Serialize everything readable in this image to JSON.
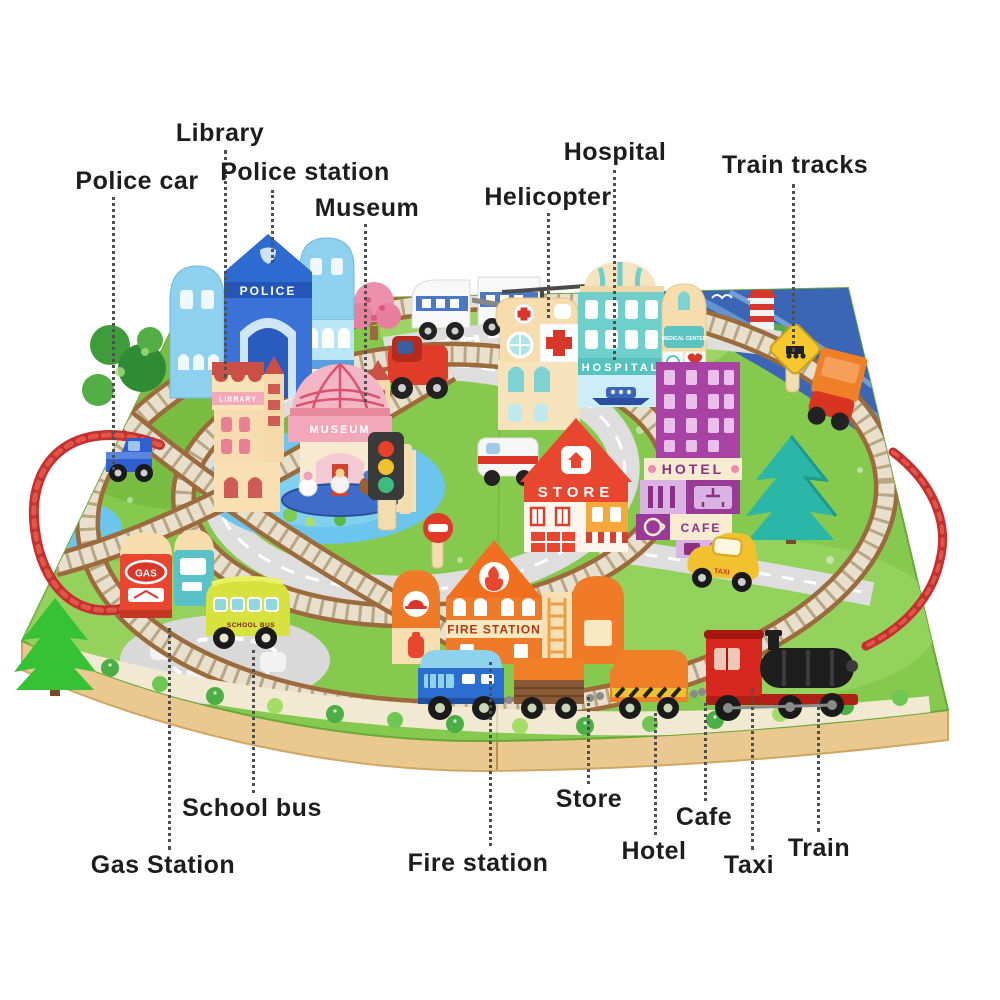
{
  "callouts": {
    "library": "Library",
    "police_car": "Police car",
    "police_station": "Police station",
    "museum": "Museum",
    "helicopter": "Helicopter",
    "hospital": "Hospital",
    "train_tracks": "Train tracks",
    "school_bus": "School bus",
    "gas_station": "Gas Station",
    "fire_station": "Fire station",
    "store": "Store",
    "hotel": "Hotel",
    "cafe": "Cafe",
    "taxi": "Taxi",
    "train": "Train"
  },
  "toy_signs": {
    "police": "POLICE",
    "library": "LIBRARY",
    "museum": "MUSEUM",
    "hospital": "HOSPITAL",
    "medical_center": "MEDICAL CENTER",
    "store": "STORE",
    "hotel": "HOTEL",
    "cafe": "CAFE",
    "fire_station": "FIRE STATION",
    "gas": "GAS",
    "school_bus": "SCHOOL BUS",
    "taxi": "TAXI"
  },
  "colors": {
    "label_text": "#1d1d1d",
    "leader_line": "#4f4f4f",
    "board_green": "#86c94f",
    "track_brown": "#9c6b3c",
    "road_gray": "#dedede",
    "wood_base": "#e9c98f",
    "police_blue": "#2e6bd0",
    "police_light_blue": "#8ed1ee",
    "museum_pink": "#f2a8ba",
    "cream": "#f7dfb2",
    "hospital_teal": "#6fcfca",
    "hotel_purple": "#a843a5",
    "store_red": "#e8462e",
    "fire_orange": "#f07020",
    "bus_yellow_green": "#d7e23e",
    "taxi_yellow": "#f2c12e",
    "train_red": "#d6281e",
    "rope_red": "#c52f2f",
    "water_blue": "#3a66b5",
    "pond_blue": "#6cc5ec"
  }
}
